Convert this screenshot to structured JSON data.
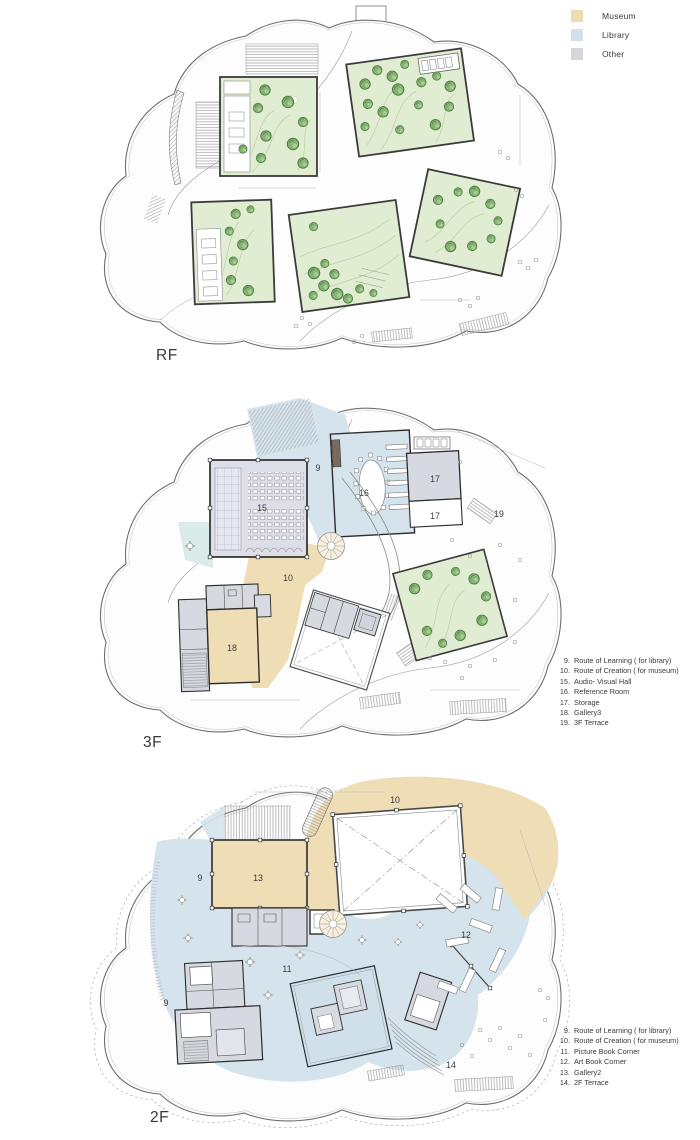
{
  "legend": {
    "items": [
      {
        "label": "Museum",
        "color": "#EFDCB2"
      },
      {
        "label": "Library",
        "color": "#D4E1EB"
      },
      {
        "label": "Other",
        "color": "#D3D6DB"
      }
    ]
  },
  "colors": {
    "museum": "#EFDDB6",
    "library": "#D5E3EC",
    "other": "#D7D9E0",
    "garden": "#E0EDD2",
    "tree": "#85B373",
    "wall": "#2D2D2D",
    "outline": "#6F6F6F"
  },
  "floors": {
    "rf": {
      "label": "RF"
    },
    "f3": {
      "label": "3F",
      "room_labels": {
        "r9": "9",
        "r10": "10",
        "r15": "15",
        "r16": "16",
        "r17a": "17",
        "r17b": "17",
        "r18": "18",
        "r19": "19"
      },
      "notes": [
        {
          "num": "9.",
          "text": "Route of Learning ( for library)"
        },
        {
          "num": "10.",
          "text": "Route of Creation ( for museum)"
        },
        {
          "num": "15.",
          "text": "Audio- Visual Hall"
        },
        {
          "num": "16.",
          "text": "Reference Room"
        },
        {
          "num": "17.",
          "text": "Storage"
        },
        {
          "num": "18.",
          "text": "Gallery3"
        },
        {
          "num": "19.",
          "text": "3F Terrace"
        }
      ]
    },
    "f2": {
      "label": "2F",
      "room_labels": {
        "r10": "10",
        "r13": "13",
        "r9a": "9",
        "r9b": "9",
        "r11": "11",
        "r12": "12",
        "r14": "14"
      },
      "notes": [
        {
          "num": "9.",
          "text": "Route of Learning ( for library)"
        },
        {
          "num": "10.",
          "text": "Route of Creation ( for museum)"
        },
        {
          "num": "11.",
          "text": "Picture Book Corner"
        },
        {
          "num": "12.",
          "text": "Art Book Corner"
        },
        {
          "num": "13.",
          "text": "Gallery2"
        },
        {
          "num": "14.",
          "text": "2F Terrace"
        }
      ]
    }
  }
}
